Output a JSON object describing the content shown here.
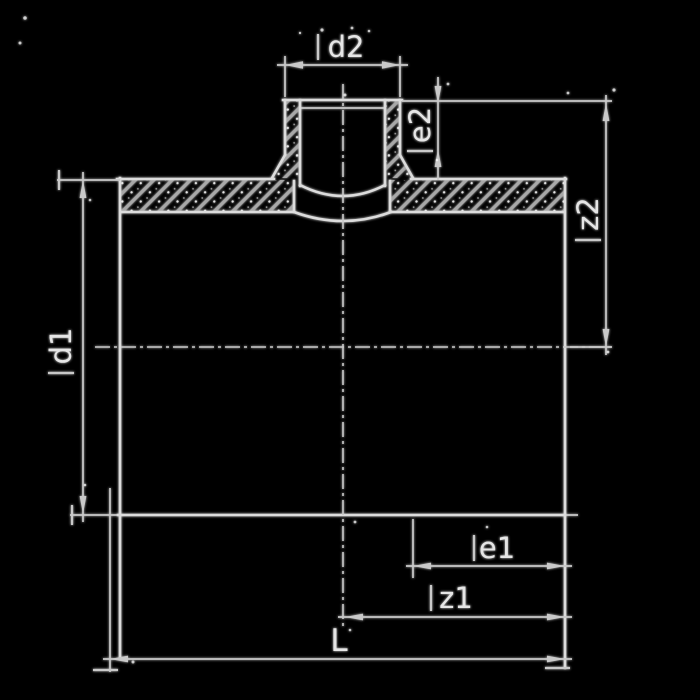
{
  "drawing": {
    "kind": "pipe-fitting-dimension-drawing",
    "labels": {
      "d2": "d2",
      "e2": "e2",
      "z2": "z2",
      "d1": "d1",
      "e1": "e1",
      "z1": "z1",
      "L": "L"
    }
  },
  "colors": {
    "background": "#000000",
    "line_primary": "#dcdcdc",
    "line_dim": "#c9c9c9",
    "hatch_line": "#a8a8a8",
    "label_text": "#e6e6e6",
    "speckle": "#ffffff"
  }
}
